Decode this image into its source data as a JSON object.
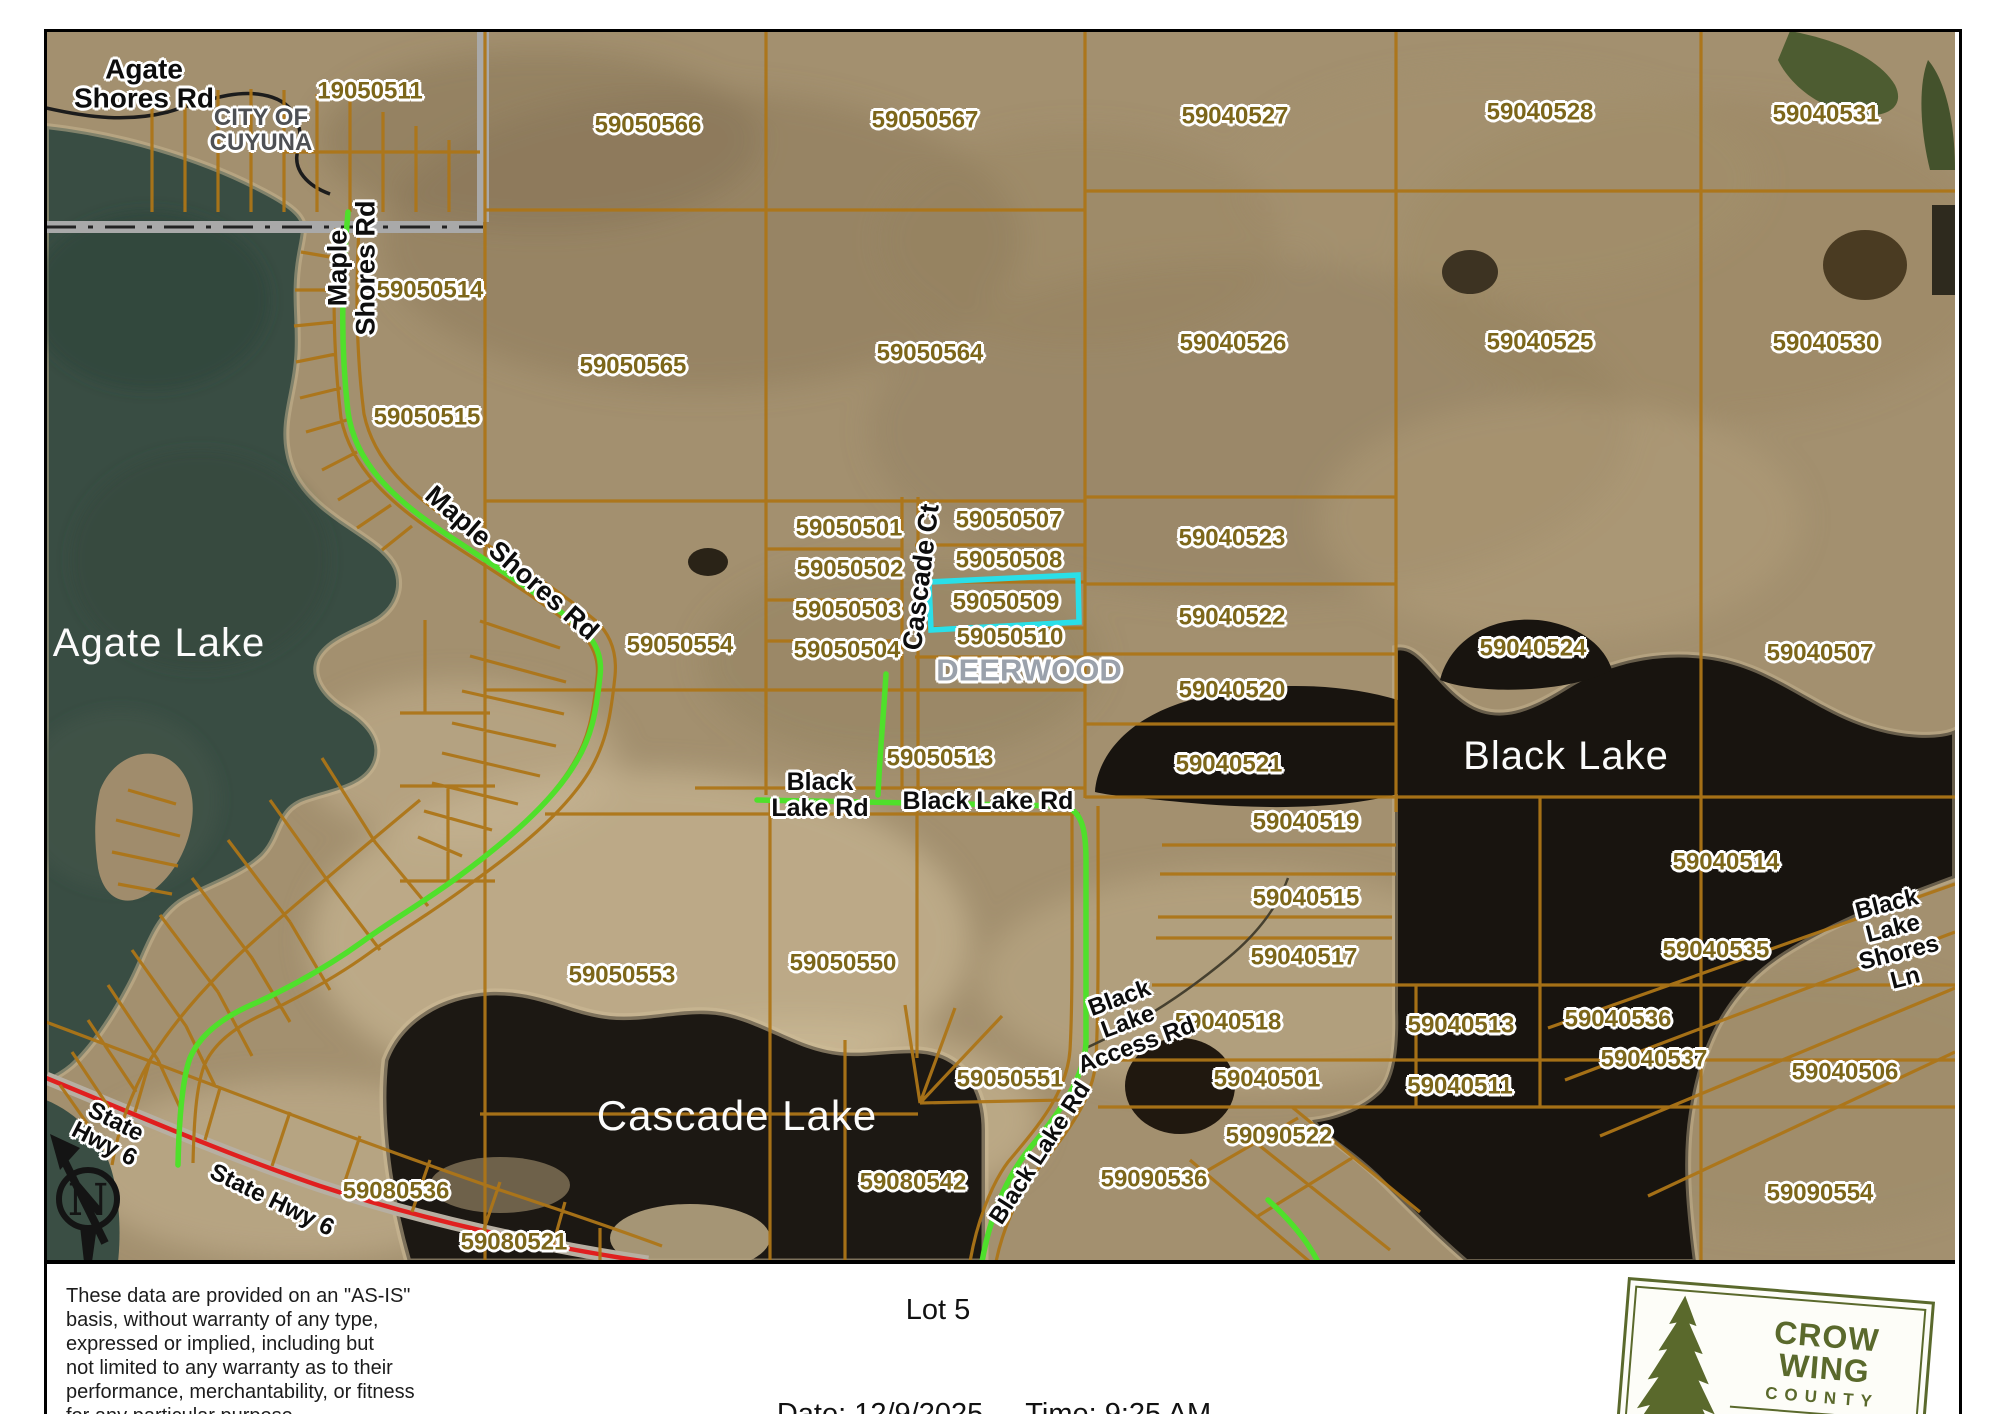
{
  "map": {
    "highlighted_parcel": "59050509",
    "colors": {
      "parcel_line": "#ad7517",
      "highlight_outline": "#2adfe8",
      "route_highlight": "#4fe02b",
      "highway": "#e01f1f",
      "parcel_text": "#7c661a",
      "logo_green": "#5a692c"
    },
    "parcel_labels": [
      {
        "t": "19050511",
        "x": 370,
        "y": 91
      },
      {
        "t": "59050566",
        "x": 648,
        "y": 125
      },
      {
        "t": "59050567",
        "x": 925,
        "y": 120
      },
      {
        "t": "59040527",
        "x": 1235,
        "y": 116
      },
      {
        "t": "59040528",
        "x": 1540,
        "y": 112
      },
      {
        "t": "59040531",
        "x": 1826,
        "y": 114
      },
      {
        "t": "59050514",
        "x": 430,
        "y": 290
      },
      {
        "t": "59050565",
        "x": 633,
        "y": 366
      },
      {
        "t": "59050564",
        "x": 930,
        "y": 353
      },
      {
        "t": "59040526",
        "x": 1233,
        "y": 343
      },
      {
        "t": "59040525",
        "x": 1540,
        "y": 342
      },
      {
        "t": "59040530",
        "x": 1826,
        "y": 343
      },
      {
        "t": "59050515",
        "x": 427,
        "y": 417
      },
      {
        "t": "59050501",
        "x": 849,
        "y": 528
      },
      {
        "t": "59050507",
        "x": 1009,
        "y": 520
      },
      {
        "t": "59040523",
        "x": 1232,
        "y": 538
      },
      {
        "t": "59050502",
        "x": 850,
        "y": 569
      },
      {
        "t": "59050508",
        "x": 1009,
        "y": 560
      },
      {
        "t": "59050509",
        "x": 1006,
        "y": 602
      },
      {
        "t": "59040522",
        "x": 1232,
        "y": 617
      },
      {
        "t": "59050503",
        "x": 848,
        "y": 610
      },
      {
        "t": "59050510",
        "x": 1010,
        "y": 637
      },
      {
        "t": "59050504",
        "x": 847,
        "y": 650
      },
      {
        "t": "59050554",
        "x": 680,
        "y": 645
      },
      {
        "t": "59040520",
        "x": 1232,
        "y": 690
      },
      {
        "t": "59040524",
        "x": 1533,
        "y": 648
      },
      {
        "t": "59040507",
        "x": 1820,
        "y": 653
      },
      {
        "t": "59040521",
        "x": 1229,
        "y": 764
      },
      {
        "t": "59050513",
        "x": 940,
        "y": 758
      },
      {
        "t": "59040519",
        "x": 1306,
        "y": 822
      },
      {
        "t": "59040515",
        "x": 1306,
        "y": 898
      },
      {
        "t": "59040514",
        "x": 1726,
        "y": 862
      },
      {
        "t": "59040517",
        "x": 1304,
        "y": 957
      },
      {
        "t": "59040535",
        "x": 1716,
        "y": 950
      },
      {
        "t": "59050553",
        "x": 622,
        "y": 975
      },
      {
        "t": "59050550",
        "x": 843,
        "y": 963
      },
      {
        "t": "59040518",
        "x": 1228,
        "y": 1022
      },
      {
        "t": "59040513",
        "x": 1461,
        "y": 1025
      },
      {
        "t": "59040536",
        "x": 1618,
        "y": 1019
      },
      {
        "t": "59040537",
        "x": 1654,
        "y": 1059
      },
      {
        "t": "59040506",
        "x": 1845,
        "y": 1072
      },
      {
        "t": "59040501",
        "x": 1267,
        "y": 1079
      },
      {
        "t": "59040511",
        "x": 1460,
        "y": 1086
      },
      {
        "t": "59050551",
        "x": 1010,
        "y": 1079
      },
      {
        "t": "59090522",
        "x": 1279,
        "y": 1136
      },
      {
        "t": "59080536",
        "x": 396,
        "y": 1191
      },
      {
        "t": "59090536",
        "x": 1154,
        "y": 1179
      },
      {
        "t": "59080542",
        "x": 913,
        "y": 1182
      },
      {
        "t": "59080521",
        "x": 514,
        "y": 1242
      },
      {
        "t": "59090554",
        "x": 1820,
        "y": 1193
      }
    ],
    "road_labels": [
      {
        "t": "Agate\nShores Rd",
        "x": 144,
        "y": 84,
        "r": 0,
        "s": 28
      },
      {
        "t": "Maple\nShores Rd",
        "x": 352,
        "y": 268,
        "r": -90,
        "s": 27
      },
      {
        "t": "Maple Shores Rd",
        "x": 512,
        "y": 563,
        "r": 41,
        "s": 27
      },
      {
        "t": "Cascade Ct",
        "x": 921,
        "y": 577,
        "r": -83,
        "s": 27
      },
      {
        "t": "Black\nLake Rd",
        "x": 820,
        "y": 795,
        "r": 0,
        "s": 25
      },
      {
        "t": "Black Lake Rd",
        "x": 988,
        "y": 801,
        "r": 0,
        "s": 25
      },
      {
        "t": "Black\nLake\nAccess Rd",
        "x": 1128,
        "y": 1022,
        "r": -20,
        "s": 24
      },
      {
        "t": "Black Lake Rd",
        "x": 1040,
        "y": 1153,
        "r": -57,
        "s": 24
      },
      {
        "t": "State\nHwy 6",
        "x": 110,
        "y": 1133,
        "r": 27,
        "s": 24
      },
      {
        "t": "State Hwy 6",
        "x": 272,
        "y": 1200,
        "r": 26,
        "s": 24
      },
      {
        "t": "Black\nLake\nShores Ln",
        "x": 1896,
        "y": 941,
        "r": -14,
        "s": 24
      }
    ],
    "place_labels": [
      {
        "t": "CITY OF\nCUYUNA",
        "x": 261,
        "y": 130,
        "s": 24,
        "c": "#4e5054"
      },
      {
        "t": "DEERWOOD",
        "x": 1029,
        "y": 671,
        "s": 31,
        "c": "#9aa1ab"
      }
    ],
    "lake_labels": [
      {
        "t": "Agate Lake",
        "x": 159,
        "y": 643,
        "s": 40
      },
      {
        "t": "Black Lake",
        "x": 1566,
        "y": 756,
        "s": 40
      },
      {
        "t": "Cascade Lake",
        "x": 737,
        "y": 1116,
        "s": 42
      }
    ]
  },
  "north_label": "N",
  "footer": {
    "disclaimer_lines": [
      "These data are provided on an \"AS-IS\"",
      "basis, without warranty of any type,",
      "expressed or implied, including but",
      "not limited to any warranty as to their",
      "performance, merchantability, or fitness",
      "for any particular purpose."
    ],
    "lot_label": "Lot 5",
    "date_label": "Date: 12/9/2025",
    "time_label": "Time: 9:25 AM"
  },
  "logo": {
    "name1": "CROW WING",
    "name2": "COUNTY",
    "name3": "MINNESOTA"
  }
}
